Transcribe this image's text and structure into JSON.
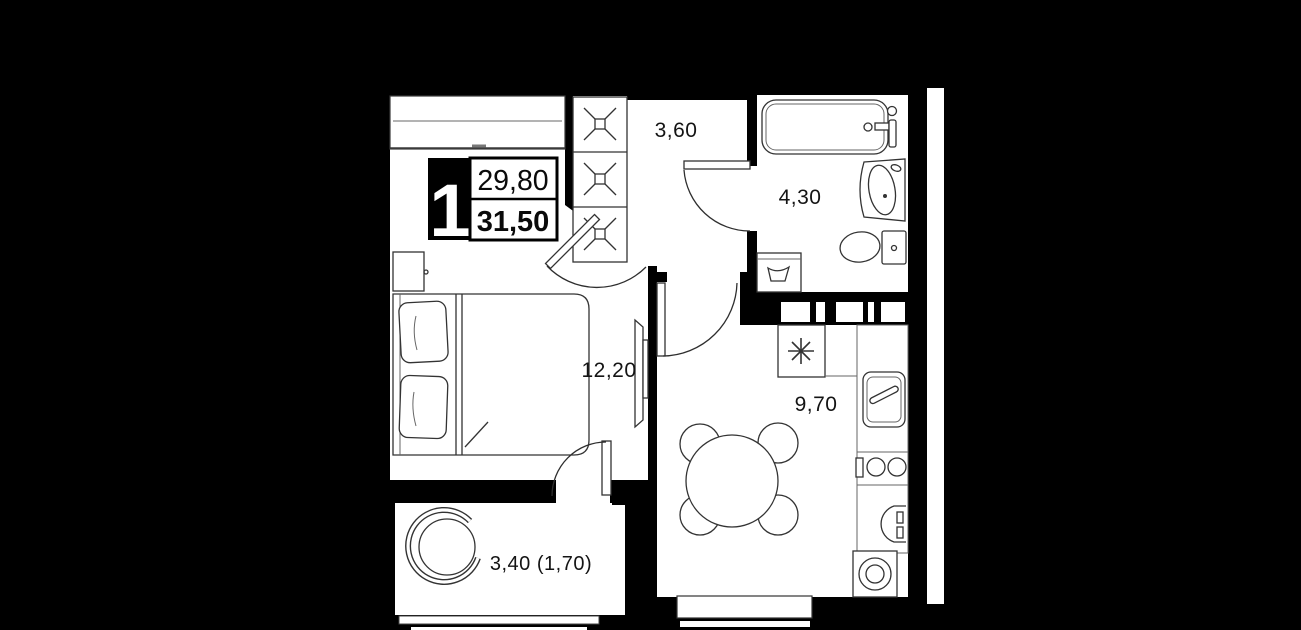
{
  "unit_card": {
    "room_count": "1",
    "area_top": "29,80",
    "area_bottom": "31,50"
  },
  "rooms": {
    "hallway": {
      "area": "3,60"
    },
    "bathroom": {
      "area": "4,30"
    },
    "bedroom": {
      "area": "12,20"
    },
    "kitchen_living": {
      "area": "9,70"
    },
    "balcony": {
      "area": "3,40 (1,70)"
    }
  },
  "icons": {
    "fridge_snowflake": "✳",
    "wardrobe_section": "✕"
  },
  "colors": {
    "background": "#000000",
    "floor": "#ffffff",
    "walls": "#000000",
    "lines": "#2e2e2e",
    "text": "#141414",
    "card_badge_bg": "#000000",
    "card_badge_text": "#ffffff"
  }
}
